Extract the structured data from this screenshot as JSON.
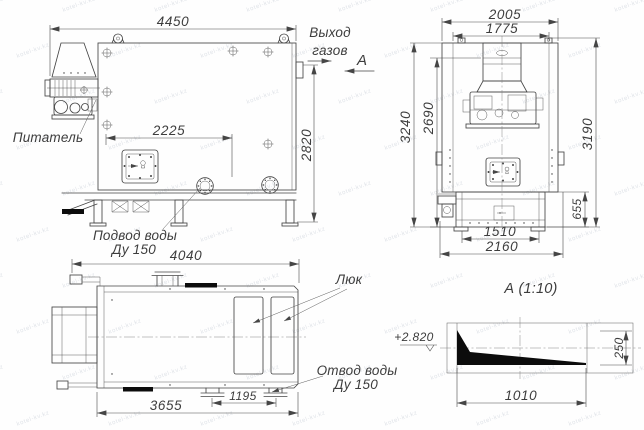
{
  "watermark": {
    "text": "kotel-kv.kz"
  },
  "labels": {
    "gas_out_1": "Выход",
    "gas_out_2": "газов",
    "section_letter": "А",
    "feeder": "Питатель",
    "water_in_1": "Подвод воды",
    "water_in_2": "Ду 150",
    "hatch": "Люк",
    "water_out_1": "Отвод воды",
    "water_out_2": "Ду 150",
    "detail_title": "А  (1:10)",
    "elevation": "+2.820"
  },
  "dims": {
    "side": {
      "overall": "4450",
      "hatch_offset": "2225",
      "height": "2820"
    },
    "front": {
      "overall_width": "2005",
      "inner_width": "1775",
      "height_total": "3240",
      "height_body": "2690",
      "height_right": "3190",
      "base_height": "655",
      "base_span": "1510",
      "base_overall": "2160"
    },
    "plan": {
      "overall": "4040",
      "support_span": "1195",
      "body_length": "3655"
    },
    "detail": {
      "length": "1010",
      "height": "250"
    }
  }
}
